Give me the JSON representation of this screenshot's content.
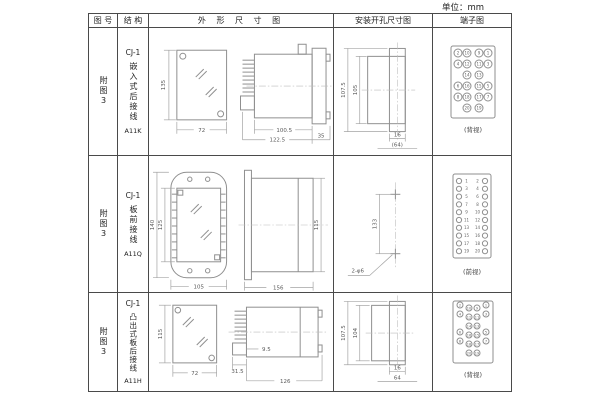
{
  "unit_label": "单位：mm",
  "header": {
    "fig_no": "图 号",
    "structure": "结 构",
    "outline": "外 形 尺 寸 图",
    "install": "安装开孔尺寸图",
    "terminal": "端子图"
  },
  "rows": [
    {
      "fig_no": "附图3",
      "model": "CJ-1",
      "structure": "嵌入式后接线",
      "code": "A11K",
      "outline": {
        "front_height": "135",
        "front_width": "72",
        "body_length": "100.5",
        "total_length": "122.5",
        "flange_depth": "35"
      },
      "install": {
        "height_outer": "107.5",
        "height_inner": "105",
        "width_inner": "16",
        "width_outer": "(64)"
      },
      "terminal": {
        "caption": "(背视)",
        "grid": [
          [
            "2",
            "10",
            "9",
            "1"
          ],
          [
            "4",
            "12",
            "11",
            "3"
          ],
          [
            "",
            "14",
            "13",
            ""
          ],
          [
            "6",
            "16",
            "15",
            "5"
          ],
          [
            "8",
            "18",
            "17",
            "7"
          ],
          [
            "",
            "20",
            "19",
            ""
          ]
        ]
      }
    },
    {
      "fig_no": "附图3",
      "model": "CJ-1",
      "structure": "板前接线",
      "code": "A11Q",
      "outline": {
        "height_outer": "140",
        "height_inner": "125",
        "front_width": "105",
        "side_length": "156",
        "side_height": "115"
      },
      "install": {
        "hole_spacing": "133",
        "hole_label": "2-φ6"
      },
      "terminal": {
        "caption": "(前视)",
        "pairs": [
          [
            "1",
            "2"
          ],
          [
            "3",
            "4"
          ],
          [
            "5",
            "6"
          ],
          [
            "7",
            "8"
          ],
          [
            "9",
            "10"
          ],
          [
            "11",
            "12"
          ],
          [
            "13",
            "14"
          ],
          [
            "15",
            "16"
          ],
          [
            "17",
            "18"
          ],
          [
            "19",
            "20"
          ]
        ]
      }
    },
    {
      "fig_no": "附图3",
      "model": "CJ-1",
      "structure": "凸出式板后接线",
      "code": "A11H",
      "outline": {
        "front_height": "115",
        "front_width": "72",
        "base_depth": "31.5",
        "gap": "9.5",
        "body_length": "126"
      },
      "install": {
        "height_outer": "107.5",
        "height_inner": "104",
        "width_inner": "16",
        "width_outer": "64"
      },
      "terminal": {
        "caption": "(背视)",
        "grid": [
          [
            "2",
            "10",
            "9",
            "1"
          ],
          [
            "4",
            "12",
            "11",
            "3"
          ],
          [
            "",
            "14",
            "13",
            ""
          ],
          [
            "6",
            "16",
            "15",
            "5"
          ],
          [
            "8",
            "18",
            "17",
            "7"
          ],
          [
            "",
            "20",
            "19",
            ""
          ]
        ]
      }
    }
  ]
}
